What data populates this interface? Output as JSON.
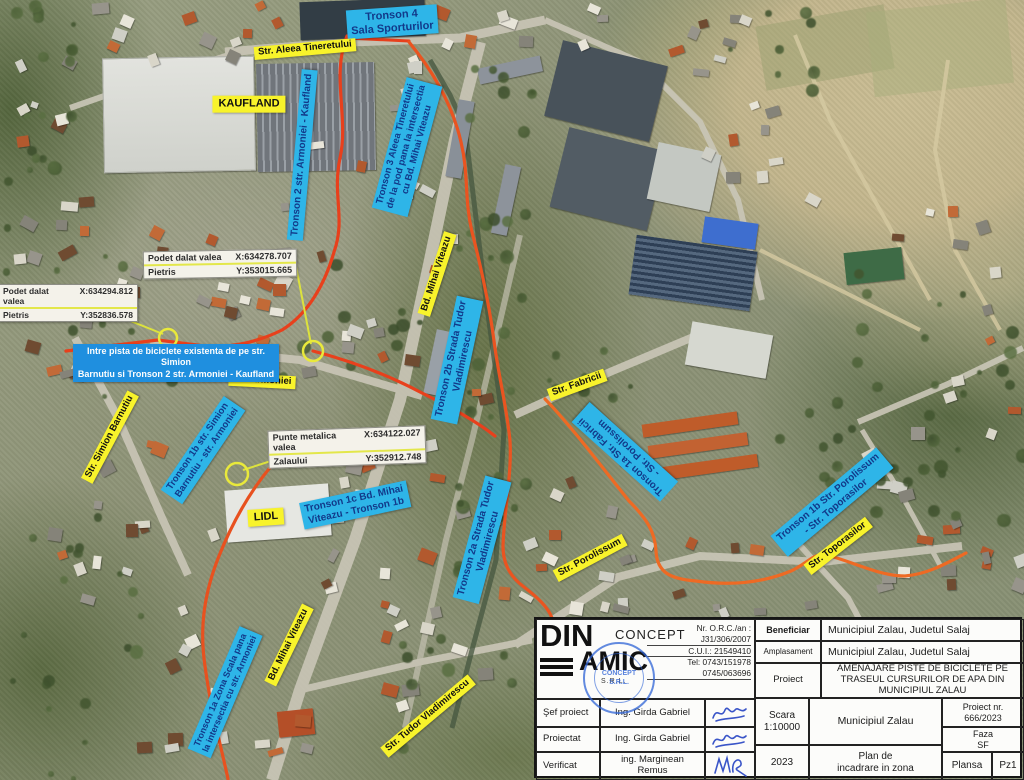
{
  "map": {
    "poi_labels": [
      {
        "text": "KAUFLAND"
      },
      {
        "text": "LIDL"
      }
    ],
    "street_labels": [
      {
        "text": "Str. Aleea Tineretului"
      },
      {
        "text": "Bd. Mihai Viteazu"
      },
      {
        "text": "Str. Armoniei"
      },
      {
        "text": "Str. Simion Barnutiu"
      },
      {
        "text": "Str. Fabricii"
      },
      {
        "text": "Str. Porolissum"
      },
      {
        "text": "Str. Toporasilor"
      },
      {
        "text": "Bd. Mihai Viteazu"
      },
      {
        "text": "Str. Tudor Vladimirescu"
      }
    ],
    "tronson_labels": [
      {
        "text": "Tronson 4\nSala Sporturilor"
      },
      {
        "text": "Tronson 2 str. Armoniei - Kaufland"
      },
      {
        "text": "Tronson 3 Aleea Tineretului\nde la pod pana la intersectia\ncu Bd. Mihai Viteazu"
      },
      {
        "text": "Tronson 2b Strada Tudor\nVladimirescu"
      },
      {
        "text": "Tronson 2a Strada Tudor\nVladimirescu"
      },
      {
        "text": "Tronson 1b str. Simion\nBarnutiu - str. Armoniei"
      },
      {
        "text": "Tronson 1c Bd. Mihai\nViteazu - Tronson 1b"
      },
      {
        "text": "Tronson 1a Str. Fabricii\n- Str. Porolissum"
      },
      {
        "text": "Tronson 1b Str. Porolissum\n- Str. Toporasilor"
      },
      {
        "text": "Tronson 1a Zona Scala pana\nla intersectia cu str. Armoniei"
      }
    ],
    "info_banner": "Intre pista de biciclete existenta de pe str. Simion\nBarnutiu si Tronson 2 str. Armoniei - Kaufland",
    "coordinate_labels": [
      {
        "row1_name": "Podet dalat valea",
        "row1_coord": "X:634278.707",
        "row2_name": "Pietris",
        "row2_coord": "Y:353015.665"
      },
      {
        "row1_name": "Podet dalat valea",
        "row1_coord": "X:634294.812",
        "row2_name": "Pietris",
        "row2_coord": "Y:352836.578"
      },
      {
        "row1_name": "Punte metalica valea",
        "row1_coord": "X:634122.027",
        "row2_name": "Zalaului",
        "row2_coord": "Y:352912.748"
      }
    ],
    "colors": {
      "route": "#e8481c",
      "tronson_bg": "#2eb5e8",
      "street_bg": "#f8f32b",
      "banner_bg": "#1f8fdf",
      "marker": "#e9e93b"
    }
  },
  "title_block": {
    "company": {
      "logo_din": "DIN",
      "logo_amic": "AMIC",
      "logo_concept": "CONCEPT",
      "logo_srl": "S.R.L.",
      "stamp_line1": "CONCEPT",
      "stamp_line2": "S.R.L.",
      "orc_label": "Nr. O.R.C./an :",
      "orc_value": "J31/306/2007",
      "cui": "C.U.I.: 21549410",
      "tel1": "Tel: 0743/151978",
      "tel2": "0745/063696"
    },
    "beneficiar_label": "Beneficiar",
    "beneficiar_value": "Municipiul Zalau, Judetul Salaj",
    "amplasament_label": "Amplasament",
    "amplasament_value": "Municipiul Zalau, Judetul Salaj",
    "proiect_label": "Proiect",
    "proiect_value": "AMENAJARE PISTE DE BICICLETE PE TRASEUL CURSURILOR DE APA DIN MUNICIPIUL ZALAU",
    "staff": [
      {
        "role": "Şef proiect",
        "name": "Ing. Girda Gabriel"
      },
      {
        "role": "Proiectat",
        "name": "Ing. Girda Gabriel"
      },
      {
        "role": "Verificat",
        "name": "ing. Marginean\nRemus"
      }
    ],
    "scara": "Scara\n1:10000",
    "an": "2023",
    "municipiu": "Municipiul Zalau",
    "plan": "Plan de\nincadrare in zona",
    "proiect_nr": "Proiect nr.\n666/2023",
    "faza": "Faza\nSF",
    "plansa_label": "Plansa",
    "plansa_value": "Pz1"
  }
}
